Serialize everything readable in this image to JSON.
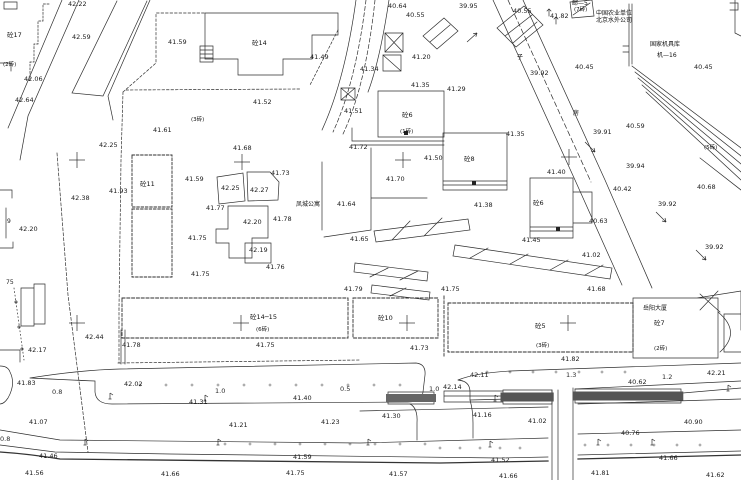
{
  "map": {
    "colors": {
      "background": "#ffffff",
      "line": "#2e2e2e",
      "heavy_line": "#333333",
      "text": "#1c1c1c",
      "hatch": "#555555"
    },
    "place_names": [
      {
        "t": "凤城公寓",
        "x": 296,
        "y": 202
      },
      {
        "t": "岳阳大厦",
        "x": 643,
        "y": 306
      },
      {
        "t": "中国农业单位",
        "x": 596,
        "y": 11
      },
      {
        "t": "北京水外公司",
        "x": 596,
        "y": 18
      },
      {
        "t": "国家机具库",
        "x": 650,
        "y": 42
      },
      {
        "t": "机—16",
        "x": 657,
        "y": 53
      },
      {
        "t": "邮—5",
        "x": 572,
        "y": 1
      },
      {
        "t": "子",
        "x": 517,
        "y": 55
      },
      {
        "t": "房",
        "x": 573,
        "y": 111
      }
    ],
    "building_labels": [
      {
        "t": "砼17",
        "x": 7,
        "y": 32
      },
      {
        "t": "砼14",
        "x": 252,
        "y": 40
      },
      {
        "t": "砼11",
        "x": 140,
        "y": 181
      },
      {
        "t": "砼6",
        "x": 402,
        "y": 112
      },
      {
        "t": "砼8",
        "x": 464,
        "y": 156
      },
      {
        "t": "砼6",
        "x": 533,
        "y": 200
      },
      {
        "t": "砼14─15",
        "x": 250,
        "y": 314
      },
      {
        "t": "砼10",
        "x": 378,
        "y": 315
      },
      {
        "t": "砼5",
        "x": 535,
        "y": 323
      },
      {
        "t": "砼7",
        "x": 654,
        "y": 320
      }
    ],
    "storey_notes": [
      {
        "t": "(2砖)",
        "x": 3,
        "y": 63
      },
      {
        "t": "(3砖)",
        "x": 191,
        "y": 118
      },
      {
        "t": "(7砖)",
        "x": 574,
        "y": 8
      },
      {
        "t": "(1砖)",
        "x": 400,
        "y": 130
      },
      {
        "t": "(6砖)",
        "x": 256,
        "y": 328
      },
      {
        "t": "(3砖)",
        "x": 536,
        "y": 344
      },
      {
        "t": "(2砖)",
        "x": 654,
        "y": 347
      },
      {
        "t": "(5砖)",
        "x": 704,
        "y": 146
      }
    ],
    "spot_elevations": [
      {
        "t": "42.22",
        "x": 68,
        "y": 1
      },
      {
        "t": "40.64",
        "x": 388,
        "y": 3
      },
      {
        "t": "40.55",
        "x": 406,
        "y": 12
      },
      {
        "t": "39.95",
        "x": 459,
        "y": 3
      },
      {
        "t": "40.55",
        "x": 513,
        "y": 8
      },
      {
        "t": "41.82",
        "x": 550,
        "y": 13
      },
      {
        "t": "42.59",
        "x": 72,
        "y": 34
      },
      {
        "t": "41.59",
        "x": 168,
        "y": 39
      },
      {
        "t": "41.49",
        "x": 310,
        "y": 54
      },
      {
        "t": "41.20",
        "x": 412,
        "y": 54
      },
      {
        "t": "42.06",
        "x": 24,
        "y": 76
      },
      {
        "t": "42.64",
        "x": 15,
        "y": 97
      },
      {
        "t": "41.34",
        "x": 360,
        "y": 66
      },
      {
        "t": "41.35",
        "x": 411,
        "y": 82
      },
      {
        "t": "41.29",
        "x": 447,
        "y": 86
      },
      {
        "t": "40.45",
        "x": 575,
        "y": 64
      },
      {
        "t": "40.45",
        "x": 694,
        "y": 64
      },
      {
        "t": "39.92",
        "x": 530,
        "y": 70
      },
      {
        "t": "41.52",
        "x": 253,
        "y": 99
      },
      {
        "t": "41.51",
        "x": 344,
        "y": 108
      },
      {
        "t": "41.61",
        "x": 153,
        "y": 127
      },
      {
        "t": "42.25",
        "x": 99,
        "y": 142
      },
      {
        "t": "41.35",
        "x": 506,
        "y": 131
      },
      {
        "t": "40.59",
        "x": 626,
        "y": 123
      },
      {
        "t": "39.91",
        "x": 593,
        "y": 129
      },
      {
        "t": "41.72",
        "x": 349,
        "y": 144
      },
      {
        "t": "41.68",
        "x": 233,
        "y": 145
      },
      {
        "t": "41.50",
        "x": 424,
        "y": 155
      },
      {
        "t": "39.94",
        "x": 626,
        "y": 163
      },
      {
        "t": "41.40",
        "x": 547,
        "y": 169
      },
      {
        "t": "41.73",
        "x": 271,
        "y": 170
      },
      {
        "t": "41.59",
        "x": 185,
        "y": 176
      },
      {
        "t": "41.70",
        "x": 386,
        "y": 176
      },
      {
        "t": "42.25",
        "x": 221,
        "y": 185
      },
      {
        "t": "42.27",
        "x": 250,
        "y": 187
      },
      {
        "t": "41.93",
        "x": 109,
        "y": 188
      },
      {
        "t": "40.42",
        "x": 613,
        "y": 186
      },
      {
        "t": "40.68",
        "x": 697,
        "y": 184
      },
      {
        "t": "42.38",
        "x": 71,
        "y": 195
      },
      {
        "t": "41.64",
        "x": 337,
        "y": 201
      },
      {
        "t": "39.92",
        "x": 658,
        "y": 201
      },
      {
        "t": "41.38",
        "x": 474,
        "y": 202
      },
      {
        "t": "41.77",
        "x": 206,
        "y": 205
      },
      {
        "t": "42.20",
        "x": 243,
        "y": 219
      },
      {
        "t": "41.78",
        "x": 273,
        "y": 216
      },
      {
        "t": "40.63",
        "x": 589,
        "y": 218
      },
      {
        "t": "42.20",
        "x": 19,
        "y": 226
      },
      {
        "t": "41.75",
        "x": 188,
        "y": 235
      },
      {
        "t": "41.65",
        "x": 350,
        "y": 236
      },
      {
        "t": "41.45",
        "x": 522,
        "y": 237
      },
      {
        "t": "39.92",
        "x": 705,
        "y": 244
      },
      {
        "t": "42.19",
        "x": 249,
        "y": 247
      },
      {
        "t": "41.02",
        "x": 582,
        "y": 252
      },
      {
        "t": "41.76",
        "x": 266,
        "y": 264
      },
      {
        "t": "41.75",
        "x": 191,
        "y": 271
      },
      {
        "t": "41.79",
        "x": 344,
        "y": 286
      },
      {
        "t": "41.75",
        "x": 441,
        "y": 286
      },
      {
        "t": "41.68",
        "x": 587,
        "y": 286
      },
      {
        "t": "42.44",
        "x": 85,
        "y": 334
      },
      {
        "t": "42.17",
        "x": 28,
        "y": 347
      },
      {
        "t": "41.78",
        "x": 122,
        "y": 342
      },
      {
        "t": "41.75",
        "x": 256,
        "y": 342
      },
      {
        "t": "41.73",
        "x": 410,
        "y": 345
      },
      {
        "t": "41.82",
        "x": 561,
        "y": 356
      },
      {
        "t": "42.11",
        "x": 470,
        "y": 372
      },
      {
        "t": "42.21",
        "x": 707,
        "y": 370
      },
      {
        "t": "41.83",
        "x": 17,
        "y": 380
      },
      {
        "t": "42.02",
        "x": 124,
        "y": 381
      },
      {
        "t": "42.14",
        "x": 443,
        "y": 384
      },
      {
        "t": "40.62",
        "x": 628,
        "y": 379
      },
      {
        "t": "41.31",
        "x": 189,
        "y": 399
      },
      {
        "t": "41.40",
        "x": 293,
        "y": 395
      },
      {
        "t": "41.30",
        "x": 382,
        "y": 413
      },
      {
        "t": "41.16",
        "x": 473,
        "y": 412
      },
      {
        "t": "41.02",
        "x": 528,
        "y": 418
      },
      {
        "t": "41.07",
        "x": 29,
        "y": 419
      },
      {
        "t": "41.21",
        "x": 229,
        "y": 422
      },
      {
        "t": "41.23",
        "x": 321,
        "y": 419
      },
      {
        "t": "40.90",
        "x": 684,
        "y": 419
      },
      {
        "t": "40.76",
        "x": 621,
        "y": 430
      },
      {
        "t": "41.46",
        "x": 39,
        "y": 453
      },
      {
        "t": "41.59",
        "x": 293,
        "y": 454
      },
      {
        "t": "41.52",
        "x": 491,
        "y": 457
      },
      {
        "t": "41.66",
        "x": 659,
        "y": 455
      },
      {
        "t": "41.56",
        "x": 25,
        "y": 470
      },
      {
        "t": "41.66",
        "x": 161,
        "y": 471
      },
      {
        "t": "41.75",
        "x": 286,
        "y": 470
      },
      {
        "t": "41.57",
        "x": 389,
        "y": 471
      },
      {
        "t": "41.66",
        "x": 499,
        "y": 473
      },
      {
        "t": "41.81",
        "x": 591,
        "y": 470
      },
      {
        "t": "41.62",
        "x": 706,
        "y": 472
      }
    ],
    "road_widths": [
      {
        "t": "0.8",
        "x": 52,
        "y": 389
      },
      {
        "t": "1.0",
        "x": 215,
        "y": 388
      },
      {
        "t": "0.5",
        "x": 340,
        "y": 386
      },
      {
        "t": "1.0",
        "x": 429,
        "y": 386
      },
      {
        "t": "1.3",
        "x": 566,
        "y": 372
      },
      {
        "t": "1.2",
        "x": 662,
        "y": 374
      },
      {
        "t": "0.8",
        "x": 0,
        "y": 436
      }
    ],
    "misc_marks": [
      {
        "t": "9",
        "x": 7,
        "y": 219
      },
      {
        "t": "75",
        "x": 6,
        "y": 280
      }
    ],
    "grid_crosses": [
      {
        "x": 77,
        "y": 160
      },
      {
        "x": 242,
        "y": 162
      },
      {
        "x": 403,
        "y": 160
      },
      {
        "x": 569,
        "y": 157
      },
      {
        "x": 77,
        "y": 323
      },
      {
        "x": 241,
        "y": 323
      },
      {
        "x": 407,
        "y": 323
      },
      {
        "x": 568,
        "y": 323
      }
    ],
    "tick_rows": [
      {
        "y": 385,
        "x1": 140,
        "x2": 404,
        "step": 26
      },
      {
        "y": 372,
        "x1": 487,
        "x2": 625,
        "step": 23
      },
      {
        "y": 444,
        "x1": 225,
        "x2": 425,
        "step": 25
      },
      {
        "y": 445,
        "x1": 585,
        "x2": 700,
        "step": 23
      },
      {
        "y": 448,
        "x1": 440,
        "x2": 520,
        "step": 20
      }
    ],
    "lamp_symbols": [
      {
        "x": 110,
        "y": 399
      },
      {
        "x": 205,
        "y": 401
      },
      {
        "x": 495,
        "y": 401
      },
      {
        "x": 85,
        "y": 445
      },
      {
        "x": 218,
        "y": 445
      },
      {
        "x": 368,
        "y": 445
      },
      {
        "x": 490,
        "y": 447
      },
      {
        "x": 652,
        "y": 445
      },
      {
        "x": 728,
        "y": 391
      },
      {
        "x": 598,
        "y": 445
      }
    ],
    "flow_arrows": [
      {
        "x1": 585,
        "y1": 142,
        "x2": 595,
        "y2": 152
      },
      {
        "x1": 656,
        "y1": 212,
        "x2": 666,
        "y2": 222
      },
      {
        "x1": 696,
        "y1": 250,
        "x2": 706,
        "y2": 260
      },
      {
        "x1": 467,
        "y1": 42,
        "x2": 477,
        "y2": 33
      }
    ]
  }
}
